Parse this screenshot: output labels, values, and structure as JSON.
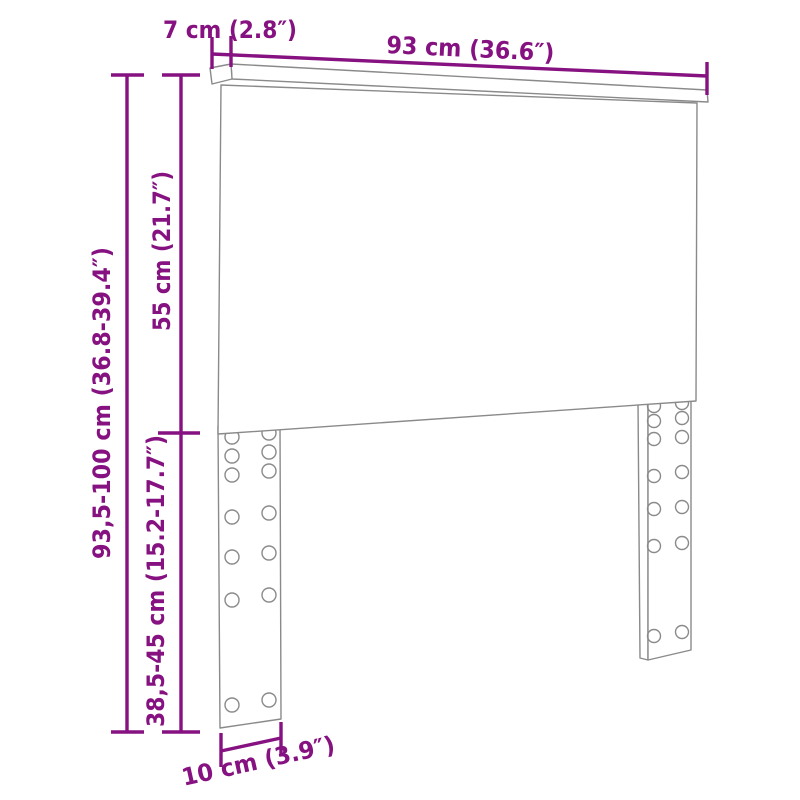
{
  "diagram": {
    "type": "furniture-dimension-diagram",
    "product": "headboard with two pre-drilled legs",
    "accent_color": "#861180",
    "line_color": "#8a8a8a",
    "labels": {
      "depth_top": "7 cm (2.8″)",
      "width_top": "93 cm (36.6″)",
      "total_height": "93,5-100 cm (36.8-39.4″)",
      "panel_height": "55 cm (21.7″)",
      "leg_height": "38,5-45 cm (15.2-17.7″)",
      "leg_width": "10 cm (3.9″)"
    }
  }
}
